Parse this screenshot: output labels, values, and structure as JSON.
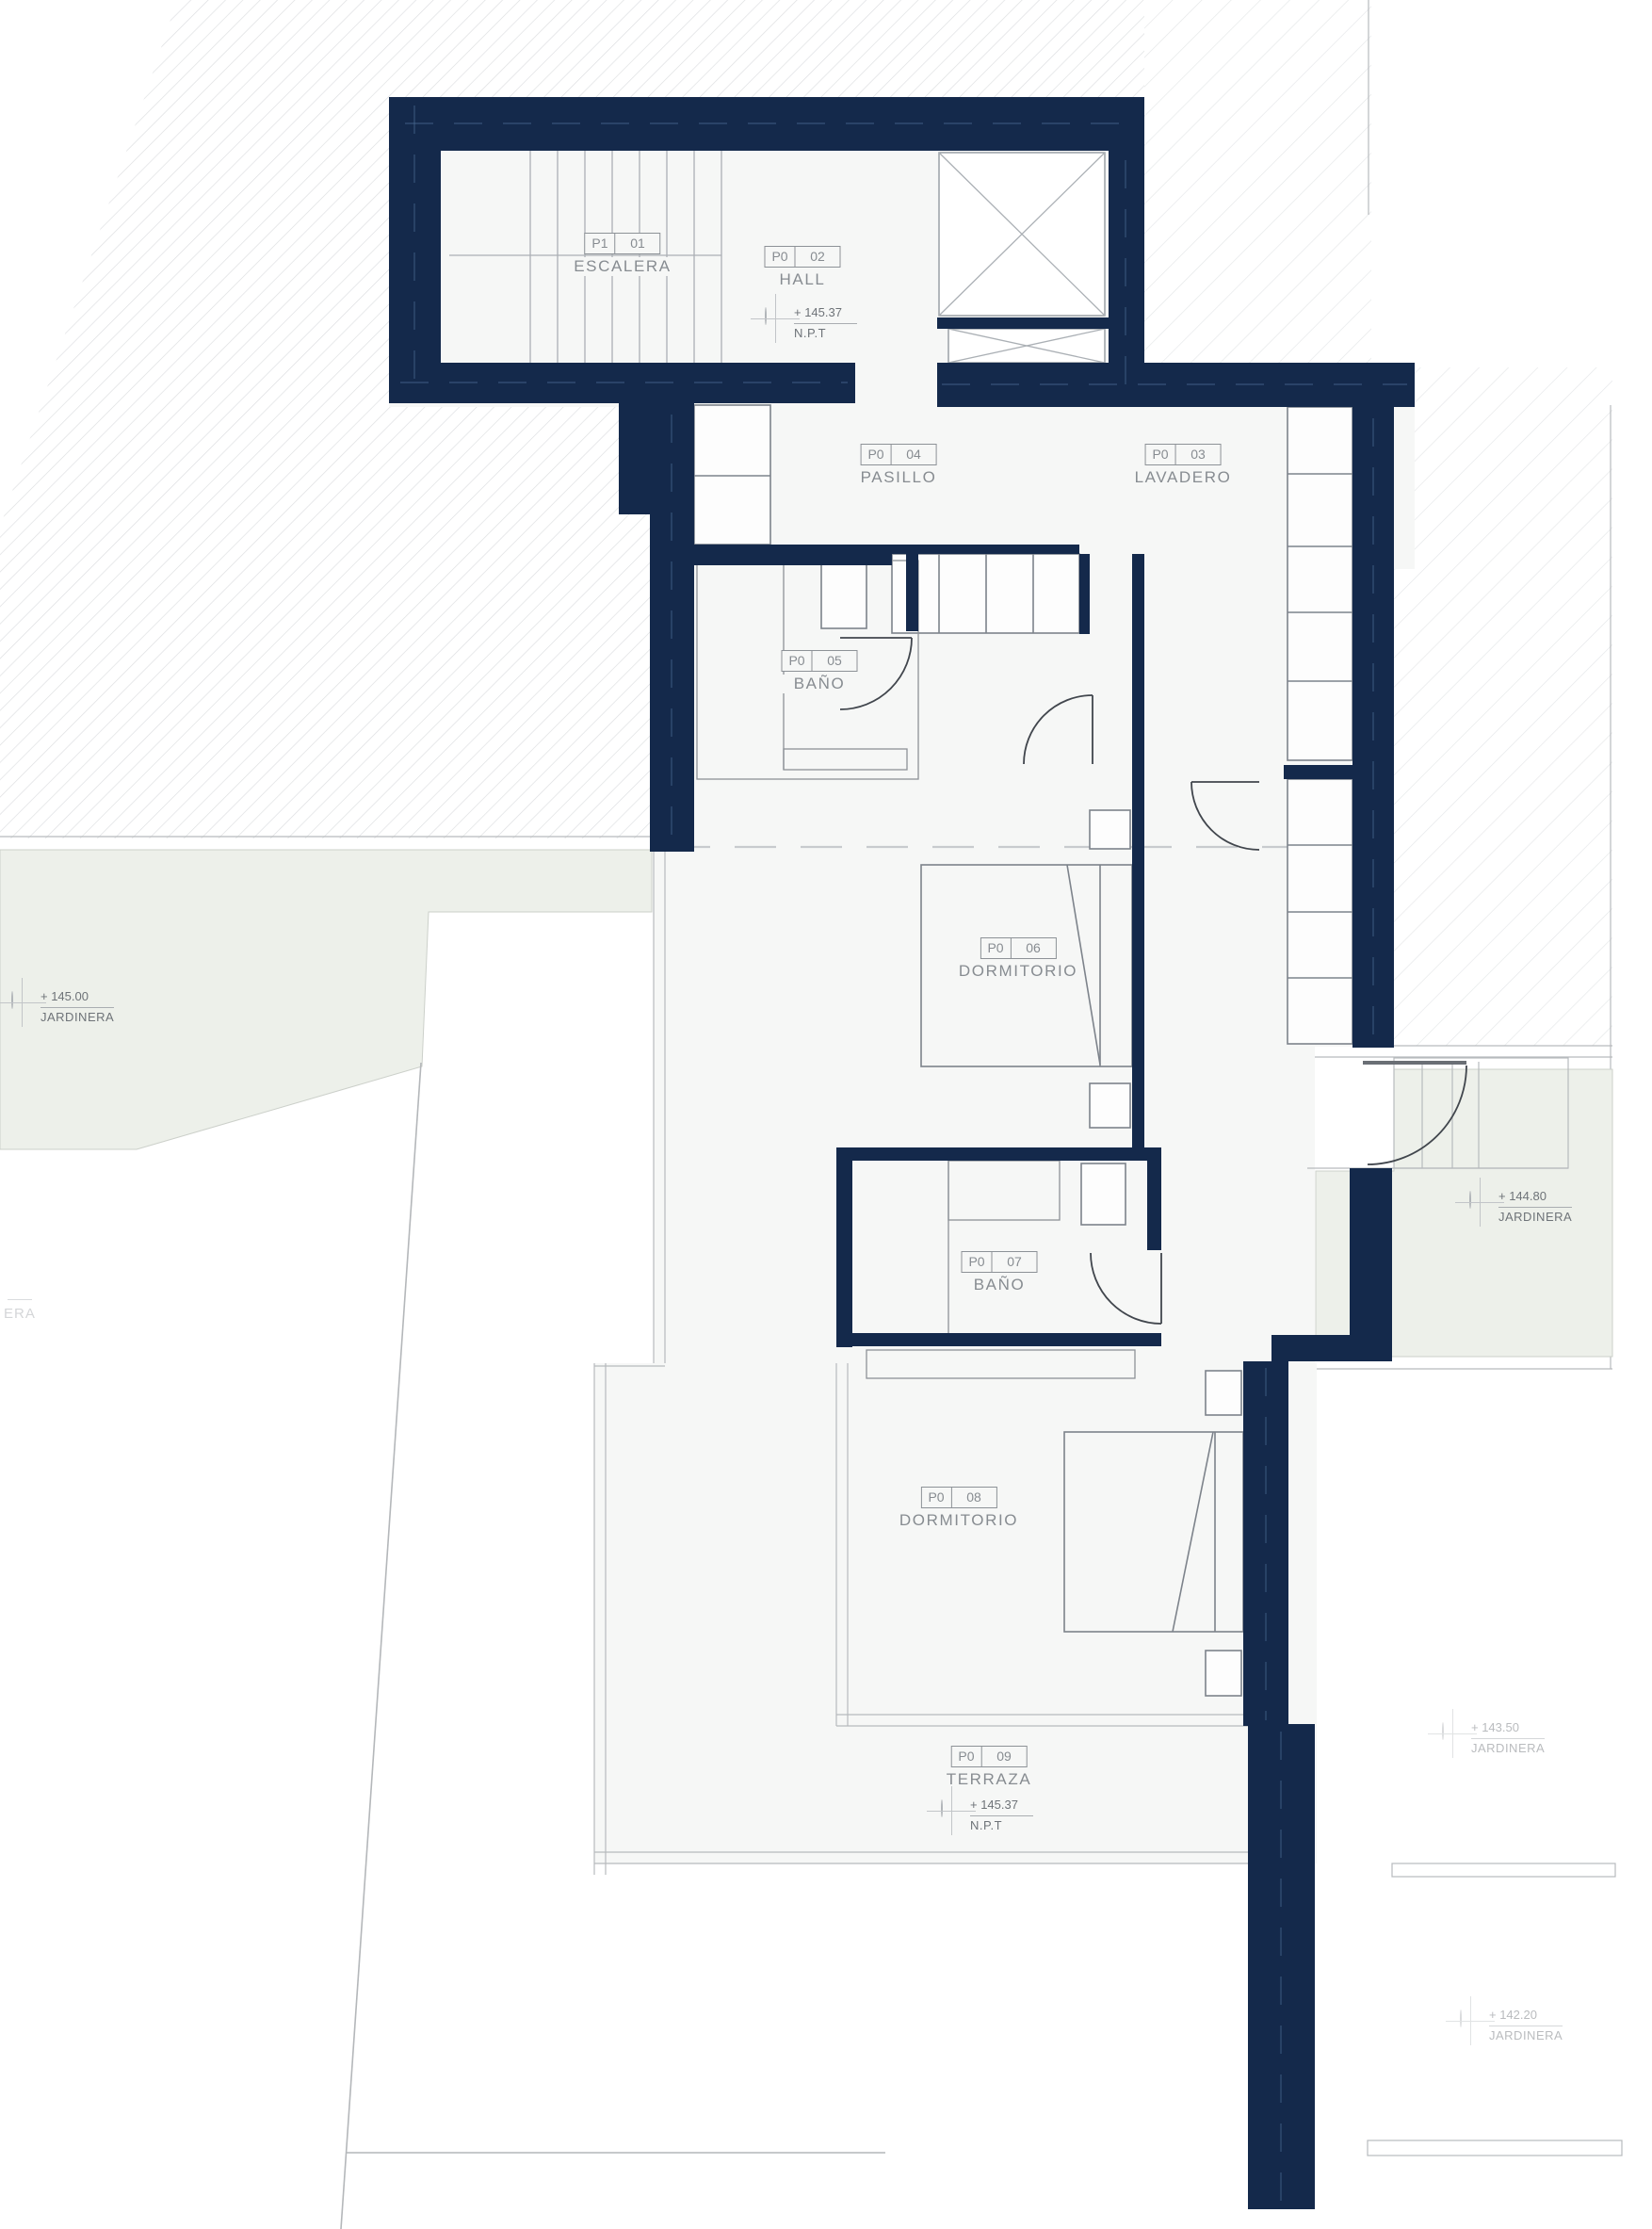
{
  "drawing": {
    "type": "architectural-floor-plan",
    "language": "es"
  },
  "rooms": [
    {
      "code": "P1",
      "num": "01",
      "name": "ESCALERA"
    },
    {
      "code": "P0",
      "num": "02",
      "name": "HALL"
    },
    {
      "code": "P0",
      "num": "03",
      "name": "LAVADERO"
    },
    {
      "code": "P0",
      "num": "04",
      "name": "PASILLO"
    },
    {
      "code": "P0",
      "num": "05",
      "name": "BAÑO"
    },
    {
      "code": "P0",
      "num": "06",
      "name": "DORMITORIO"
    },
    {
      "code": "P0",
      "num": "07",
      "name": "BAÑO"
    },
    {
      "code": "P0",
      "num": "08",
      "name": "DORMITORIO"
    },
    {
      "code": "P0",
      "num": "09",
      "name": "TERRAZA"
    }
  ],
  "levels": [
    {
      "value": "+ 145.37",
      "label": "N.P.T",
      "location": "hall"
    },
    {
      "value": "+ 145.00",
      "label": "JARDINERA",
      "location": "garden-west"
    },
    {
      "value": "+ 144.80",
      "label": "JARDINERA",
      "location": "garden-east"
    },
    {
      "value": "+ 143.50",
      "label": "JARDINERA",
      "location": "garden-southeast-upper"
    },
    {
      "value": "+ 142.20",
      "label": "JARDINERA",
      "location": "garden-southeast-lower"
    },
    {
      "value": "+ 145.37",
      "label": "N.P.T",
      "location": "terraza"
    }
  ],
  "partial": {
    "text": "ERA"
  },
  "colors": {
    "wall": "#14294b",
    "floor": "#f6f7f6",
    "garden": "#edf0ea",
    "hatch": "#dcdee0",
    "label_line": "#8d9297",
    "door_line": "#41464d",
    "wall_core_dash": "#4a6a94"
  }
}
